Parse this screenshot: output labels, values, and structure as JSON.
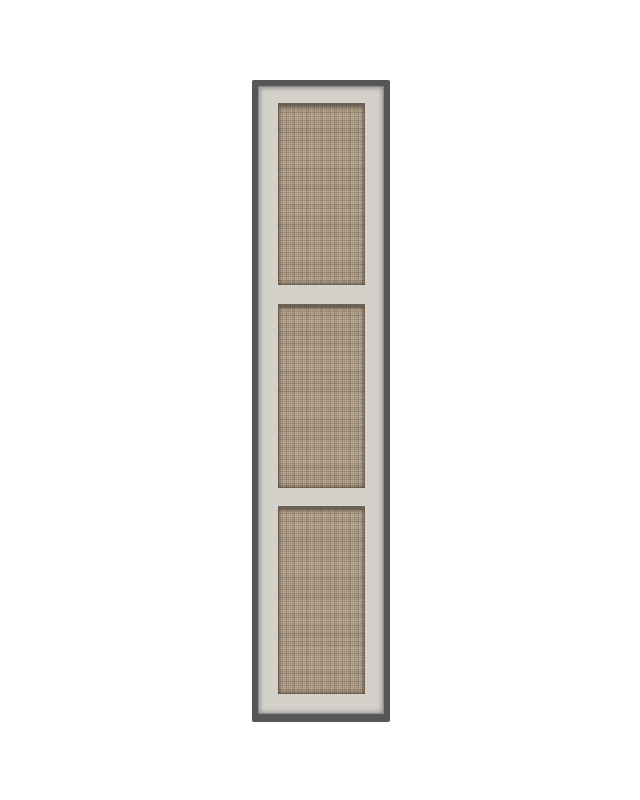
{
  "object": {
    "type": "tall wardrobe door with woven rattan inserts",
    "panel_count": 3,
    "panels": [
      {
        "position": "top"
      },
      {
        "position": "middle"
      },
      {
        "position": "bottom"
      }
    ]
  },
  "theme": {
    "canvas-bg": "#ffffff",
    "edge-color": "#55565a",
    "frame-color": "#d3d1ca",
    "rattan-base": "#b2a089",
    "rattan-light": "#c4b39a",
    "rattan-dark": "#8e7c65",
    "panel-lip-shadow": "#6b6257"
  }
}
